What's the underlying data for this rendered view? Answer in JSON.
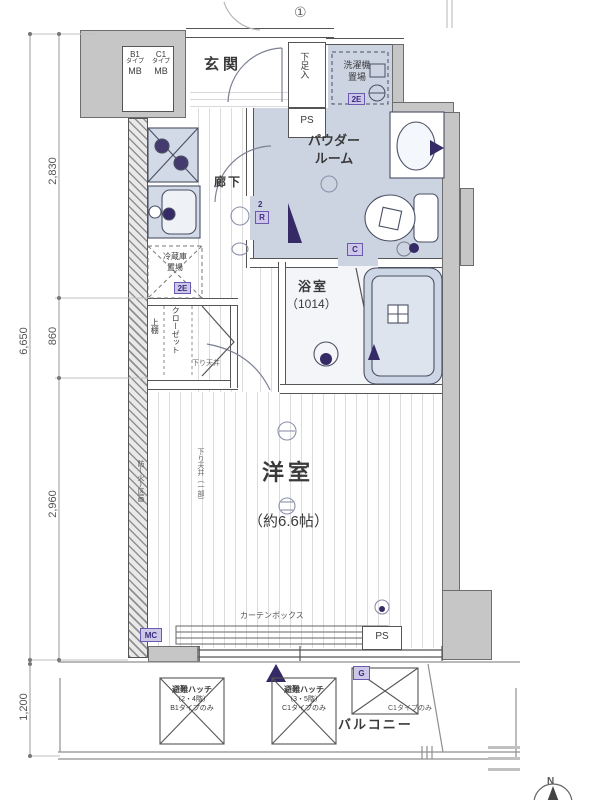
{
  "dims": {
    "overall": "6,650",
    "seg_top": "2,830",
    "seg_mid": "860",
    "seg_bottom": "2,960",
    "balcony": "1,200"
  },
  "marks": {
    "circle_one": "①",
    "north": "N"
  },
  "mb_box": {
    "columns": [
      {
        "type": "B1",
        "word": "タイプ",
        "mb": "MB"
      },
      {
        "type": "C1",
        "word": "タイプ",
        "mb": "MB"
      }
    ]
  },
  "entrance": {
    "label": "玄関",
    "shoe": "下足入",
    "ps": "PS"
  },
  "laundry": {
    "line1": "洗濯機",
    "line2": "置場",
    "tag": "2E"
  },
  "powder": {
    "line1": "パウダー",
    "line2": "ルーム",
    "toilet_tag": "C",
    "door_tag": "R",
    "door_tag_num": "2"
  },
  "bath": {
    "label": "浴室",
    "size": "（1014）"
  },
  "hall": {
    "label": "廊下"
  },
  "kitchen": {
    "fridge1": "冷蔵庫",
    "fridge2": "置場",
    "fridge_tag": "2E"
  },
  "closet": {
    "label": "クローゼット",
    "shelf": "上棚",
    "ceiling_note": "下り天井"
  },
  "room": {
    "label": "洋室",
    "size": "（約6.6帖）",
    "fire_note": "防(火)区画",
    "ceiling_note": "下り天井（一部）"
  },
  "bottom": {
    "curtain": "カーテンボックス",
    "mc": "MC",
    "ps": "PS",
    "g": "G"
  },
  "balcony": {
    "label": "バルコニー",
    "only_note": "C1タイプのみ",
    "hatches": [
      {
        "name": "避難ハッチ",
        "floors": "（2・4階）",
        "only": "B1タイプのみ"
      },
      {
        "name": "避難ハッチ",
        "floors": "（3・5階）",
        "only": "C1タイプのみ"
      }
    ]
  }
}
